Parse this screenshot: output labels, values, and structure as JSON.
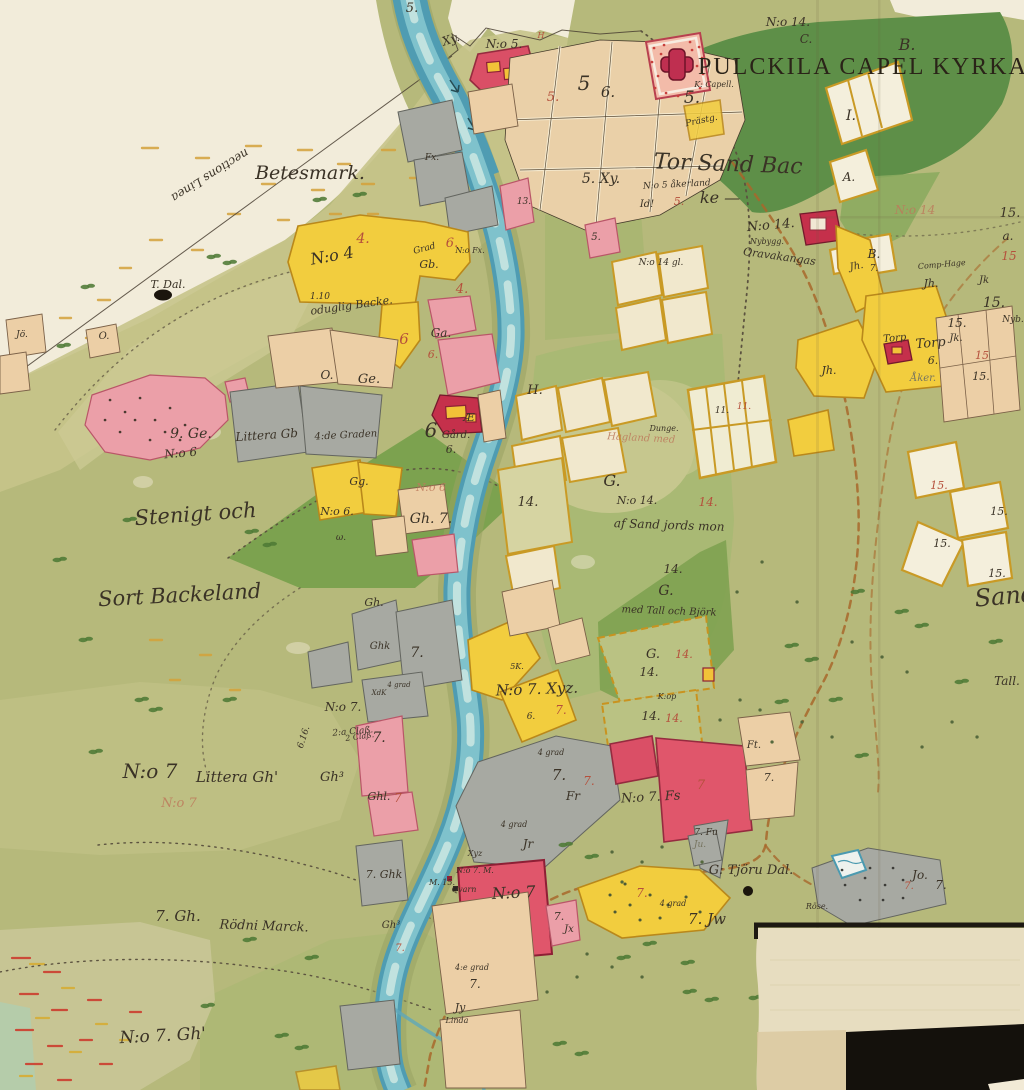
{
  "map": {
    "title": "PULCKILA CAPEL KYRKA —",
    "region_names": {
      "betesmark": "Betesmark.",
      "linea": "nections Linea",
      "stenigt": "Stenigt och",
      "backeland": "Sort Backeland",
      "torsand_1": "Tor Sand Bac",
      "torsand_2": "ke —",
      "littera_no7": "N:o 7",
      "littera_gh": "Littera Gh'",
      "rodni_1": "7. Gh.",
      "rodni_2": "Rödni Marck.",
      "no7_gh": "N:o 7. Gh'",
      "tjoru": "G: Tjöru Dal."
    }
  },
  "palette": {
    "paper": "#e9e0c6",
    "paper_light": "#f2ecda",
    "land": "#b6b97b",
    "land_light": "#c6c489",
    "forest_dark": "#5e8f48",
    "forest_mid": "#8cab5f",
    "river_deep": "#4f9cb2",
    "river_mid": "#7fc2cc",
    "river_light": "#d7ece6",
    "c_yellow": "#f2cd3e",
    "c_pink": "#eb9fa8",
    "c_red": "#da4f66",
    "c_gray": "#a7a9a2",
    "c_beige": "#eccfa6",
    "c_cream": "#f1e8cd",
    "ochre": "#c99a25",
    "ink": "#3a3226",
    "ink_red": "#b5503c",
    "road": "#a8672c",
    "black_patch": "#14110c",
    "tree": "#4e7a36"
  },
  "labels": [
    {
      "t": "N:o 14.",
      "x": 788,
      "y": 26,
      "s": 12
    },
    {
      "t": "C.",
      "x": 806,
      "y": 43,
      "s": 12
    },
    {
      "t": "B.",
      "x": 907,
      "y": 50,
      "s": 16
    },
    {
      "t": "I.",
      "x": 851,
      "y": 120,
      "s": 14
    },
    {
      "t": "A.",
      "x": 849,
      "y": 181,
      "s": 12
    },
    {
      "t": "B.",
      "x": 874,
      "y": 258,
      "s": 12
    },
    {
      "t": "7.",
      "x": 874,
      "y": 271,
      "s": 9
    },
    {
      "t": "K: Capell.",
      "x": 714,
      "y": 87,
      "s": 8
    },
    {
      "t": "Prästg.",
      "x": 702,
      "y": 123,
      "s": 9,
      "r": -12
    },
    {
      "t": "N:o 5.",
      "x": 504,
      "y": 48,
      "s": 12
    },
    {
      "t": "5.",
      "x": 412,
      "y": 12,
      "s": 13
    },
    {
      "t": "Xy.",
      "x": 452,
      "y": 43,
      "s": 12,
      "r": -18
    },
    {
      "t": "H",
      "x": 541,
      "y": 38,
      "s": 8,
      "c": "r"
    },
    {
      "t": "5.",
      "x": 553,
      "y": 101,
      "s": 13,
      "c": "r"
    },
    {
      "t": "5",
      "x": 584,
      "y": 90,
      "s": 20
    },
    {
      "t": "6.",
      "x": 608,
      "y": 97,
      "s": 15
    },
    {
      "t": "5.",
      "x": 692,
      "y": 103,
      "s": 17
    },
    {
      "t": "13.",
      "x": 524,
      "y": 204,
      "s": 9
    },
    {
      "t": "5.",
      "x": 596,
      "y": 240,
      "s": 10
    },
    {
      "t": "T. Dal.",
      "x": 168,
      "y": 288,
      "s": 11
    },
    {
      "t": "N:o 4",
      "x": 333,
      "y": 261,
      "s": 16,
      "r": -10
    },
    {
      "t": "4.",
      "x": 363,
      "y": 243,
      "s": 14,
      "c": "r"
    },
    {
      "t": "1.10",
      "x": 320,
      "y": 299,
      "s": 9
    },
    {
      "t": "oduglig Backe.",
      "x": 352,
      "y": 309,
      "s": 11,
      "r": -8
    },
    {
      "t": "Grad",
      "x": 425,
      "y": 251,
      "s": 9,
      "r": -15
    },
    {
      "t": "Gb.",
      "x": 429,
      "y": 268,
      "s": 11
    },
    {
      "t": "4.",
      "x": 462,
      "y": 293,
      "s": 13,
      "c": "r"
    },
    {
      "t": "6",
      "x": 404,
      "y": 344,
      "s": 15,
      "c": "r"
    },
    {
      "t": "Ga.",
      "x": 441,
      "y": 337,
      "s": 12
    },
    {
      "t": "6.",
      "x": 433,
      "y": 358,
      "s": 11,
      "c": "r"
    },
    {
      "t": "6.",
      "x": 452,
      "y": 247,
      "s": 13,
      "c": "r"
    },
    {
      "t": "N:o Fx.",
      "x": 470,
      "y": 253,
      "s": 8
    },
    {
      "t": "Fx.",
      "x": 432,
      "y": 160,
      "s": 9
    },
    {
      "t": "Jö.",
      "x": 22,
      "y": 337,
      "s": 9
    },
    {
      "t": "O.",
      "x": 104,
      "y": 339,
      "s": 10
    },
    {
      "t": "O.",
      "x": 327,
      "y": 379,
      "s": 12
    },
    {
      "t": "Ge.",
      "x": 369,
      "y": 383,
      "s": 13
    },
    {
      "t": "9. Ge.",
      "x": 191,
      "y": 438,
      "s": 14
    },
    {
      "t": "N:o 6",
      "x": 181,
      "y": 457,
      "s": 12,
      "r": -5
    },
    {
      "t": "Littera Gb",
      "x": 267,
      "y": 439,
      "s": 12,
      "r": -4
    },
    {
      "t": "4:de Graden",
      "x": 346,
      "y": 438,
      "s": 10,
      "r": -3
    },
    {
      "t": "N:o 6.",
      "x": 337,
      "y": 515,
      "s": 11
    },
    {
      "t": "ω.",
      "x": 341,
      "y": 540,
      "s": 9
    },
    {
      "t": "Gh.",
      "x": 374,
      "y": 606,
      "s": 11
    },
    {
      "t": "N:o 6",
      "x": 431,
      "y": 491,
      "s": 11,
      "c": "f"
    },
    {
      "t": "Gh. 7.",
      "x": 431,
      "y": 523,
      "s": 14
    },
    {
      "t": "Æ",
      "x": 469,
      "y": 421,
      "s": 11
    },
    {
      "t": "Gård.",
      "x": 456,
      "y": 438,
      "s": 10
    },
    {
      "t": "6",
      "x": 431,
      "y": 437,
      "s": 20
    },
    {
      "t": "6.",
      "x": 451,
      "y": 453,
      "s": 11
    },
    {
      "t": "Gg.",
      "x": 359,
      "y": 485,
      "s": 11
    },
    {
      "t": "H.",
      "x": 535,
      "y": 394,
      "s": 13
    },
    {
      "t": "14.",
      "x": 528,
      "y": 506,
      "s": 13
    },
    {
      "t": "5. Xy.",
      "x": 601,
      "y": 183,
      "s": 14
    },
    {
      "t": "N:o 5 åkerland",
      "x": 677,
      "y": 187,
      "s": 9,
      "r": -3
    },
    {
      "t": "Id!",
      "x": 647,
      "y": 207,
      "s": 10
    },
    {
      "t": "5.",
      "x": 679,
      "y": 205,
      "s": 11,
      "c": "r"
    },
    {
      "t": "N:o 14 gl.",
      "x": 661,
      "y": 265,
      "s": 9
    },
    {
      "t": "N:o 14.",
      "x": 771,
      "y": 229,
      "s": 13,
      "r": -5
    },
    {
      "t": "Nybygg.",
      "x": 767,
      "y": 244,
      "s": 8
    },
    {
      "t": "Oravakangas",
      "x": 779,
      "y": 260,
      "s": 11,
      "r": 8
    },
    {
      "t": "N:o 14",
      "x": 915,
      "y": 214,
      "s": 12,
      "c": "f"
    },
    {
      "t": "15.",
      "x": 1010,
      "y": 217,
      "s": 13
    },
    {
      "t": "a.",
      "x": 1008,
      "y": 240,
      "s": 12
    },
    {
      "t": "15",
      "x": 1009,
      "y": 260,
      "s": 12,
      "c": "r"
    },
    {
      "t": "Comp-Hage",
      "x": 942,
      "y": 267,
      "s": 8,
      "r": -5
    },
    {
      "t": "Jh.",
      "x": 931,
      "y": 287,
      "s": 11
    },
    {
      "t": "Jk",
      "x": 984,
      "y": 283,
      "s": 10
    },
    {
      "t": "15.",
      "x": 994,
      "y": 307,
      "s": 14
    },
    {
      "t": "Jh.",
      "x": 857,
      "y": 269,
      "s": 10,
      "r": -10
    },
    {
      "t": "Jh.",
      "x": 829,
      "y": 374,
      "s": 11
    },
    {
      "t": "Torp",
      "x": 895,
      "y": 341,
      "s": 10,
      "r": -5
    },
    {
      "t": "Torp",
      "x": 931,
      "y": 347,
      "s": 13,
      "r": -5
    },
    {
      "t": "6.",
      "x": 933,
      "y": 364,
      "s": 11
    },
    {
      "t": "15.",
      "x": 957,
      "y": 327,
      "s": 12
    },
    {
      "t": "Jk.",
      "x": 956,
      "y": 341,
      "s": 10
    },
    {
      "t": "15",
      "x": 982,
      "y": 359,
      "s": 11,
      "c": "r"
    },
    {
      "t": "15.",
      "x": 981,
      "y": 380,
      "s": 11
    },
    {
      "t": "Nyb.",
      "x": 1013,
      "y": 322,
      "s": 9
    },
    {
      "t": "Åker.",
      "x": 923,
      "y": 381,
      "s": 10,
      "c": "g"
    },
    {
      "t": "G.",
      "x": 612,
      "y": 486,
      "s": 16
    },
    {
      "t": "N:o 14.",
      "x": 637,
      "y": 504,
      "s": 11
    },
    {
      "t": "14.",
      "x": 708,
      "y": 506,
      "s": 12,
      "c": "r"
    },
    {
      "t": "af Sand jords mon",
      "x": 669,
      "y": 529,
      "s": 12,
      "r": 2
    },
    {
      "t": "Hagland med",
      "x": 641,
      "y": 441,
      "s": 10,
      "c": "f",
      "r": 3
    },
    {
      "t": "Dunge.",
      "x": 664,
      "y": 431,
      "s": 8
    },
    {
      "t": "14.",
      "x": 673,
      "y": 573,
      "s": 12
    },
    {
      "t": "G.",
      "x": 666,
      "y": 595,
      "s": 14
    },
    {
      "t": "med Tall och Björk",
      "x": 669,
      "y": 614,
      "s": 10,
      "r": 2
    },
    {
      "t": "G.",
      "x": 653,
      "y": 658,
      "s": 13
    },
    {
      "t": "14.",
      "x": 684,
      "y": 658,
      "s": 11,
      "c": "r"
    },
    {
      "t": "14.",
      "x": 649,
      "y": 676,
      "s": 12
    },
    {
      "t": "K:op",
      "x": 667,
      "y": 699,
      "s": 8
    },
    {
      "t": "14.",
      "x": 651,
      "y": 720,
      "s": 12
    },
    {
      "t": "14.",
      "x": 674,
      "y": 722,
      "s": 11,
      "c": "r"
    },
    {
      "t": "11.",
      "x": 722,
      "y": 413,
      "s": 9
    },
    {
      "t": "11.",
      "x": 744,
      "y": 409,
      "s": 9,
      "c": "r"
    },
    {
      "t": "N:o 7. Xyz.",
      "x": 537,
      "y": 694,
      "s": 15,
      "r": -2
    },
    {
      "t": "7.",
      "x": 561,
      "y": 714,
      "s": 12,
      "c": "r"
    },
    {
      "t": "4 grad",
      "x": 551,
      "y": 755,
      "s": 8
    },
    {
      "t": "7.",
      "x": 559,
      "y": 780,
      "s": 15
    },
    {
      "t": "7.",
      "x": 589,
      "y": 785,
      "s": 12,
      "c": "r"
    },
    {
      "t": "Fr",
      "x": 573,
      "y": 800,
      "s": 12
    },
    {
      "t": "4 grad",
      "x": 514,
      "y": 827,
      "s": 8
    },
    {
      "t": "Jr",
      "x": 528,
      "y": 848,
      "s": 12
    },
    {
      "t": "N:o 7. Fs",
      "x": 651,
      "y": 801,
      "s": 13,
      "r": -3
    },
    {
      "t": "7",
      "x": 701,
      "y": 789,
      "s": 13,
      "c": "r"
    },
    {
      "t": "7. Fu",
      "x": 706,
      "y": 835,
      "s": 9
    },
    {
      "t": "Ft.",
      "x": 754,
      "y": 748,
      "s": 10
    },
    {
      "t": "7.",
      "x": 769,
      "y": 781,
      "s": 11
    },
    {
      "t": "Ju.",
      "x": 700,
      "y": 847,
      "s": 9,
      "c": "g"
    },
    {
      "t": "7. Jw",
      "x": 707,
      "y": 924,
      "s": 15
    },
    {
      "t": "7.",
      "x": 642,
      "y": 897,
      "s": 12,
      "c": "r"
    },
    {
      "t": "4 grad",
      "x": 673,
      "y": 906,
      "s": 8
    },
    {
      "t": "7.",
      "x": 559,
      "y": 920,
      "s": 11
    },
    {
      "t": "Jx",
      "x": 569,
      "y": 932,
      "s": 10
    },
    {
      "t": "Xyz",
      "x": 475,
      "y": 856,
      "s": 8
    },
    {
      "t": "N:o 7. M.",
      "x": 475,
      "y": 873,
      "s": 8
    },
    {
      "t": "M. 15.",
      "x": 442,
      "y": 885,
      "s": 8
    },
    {
      "t": "Qvarn",
      "x": 464,
      "y": 892,
      "s": 8
    },
    {
      "t": "N:o 7",
      "x": 514,
      "y": 898,
      "s": 16,
      "r": -3
    },
    {
      "t": "4:e grad",
      "x": 472,
      "y": 970,
      "s": 8
    },
    {
      "t": "7.",
      "x": 475,
      "y": 988,
      "s": 12
    },
    {
      "t": "Jy",
      "x": 460,
      "y": 1011,
      "s": 11
    },
    {
      "t": "Linda",
      "x": 457,
      "y": 1023,
      "s": 8
    },
    {
      "t": "Röse.",
      "x": 817,
      "y": 909,
      "s": 8
    },
    {
      "t": "Jo.",
      "x": 920,
      "y": 879,
      "s": 12
    },
    {
      "t": "7.",
      "x": 941,
      "y": 889,
      "s": 12
    },
    {
      "t": "7.",
      "x": 909,
      "y": 889,
      "s": 10,
      "c": "r"
    },
    {
      "t": "Gh³",
      "x": 332,
      "y": 781,
      "s": 13
    },
    {
      "t": "Ghl.",
      "x": 379,
      "y": 800,
      "s": 11
    },
    {
      "t": "7",
      "x": 398,
      "y": 802,
      "s": 12,
      "c": "r"
    },
    {
      "t": "2 Claß.",
      "x": 360,
      "y": 739,
      "s": 8,
      "r": -8
    },
    {
      "t": "N:o 7",
      "x": 179,
      "y": 807,
      "s": 13,
      "c": "f"
    },
    {
      "t": "7. Ghk",
      "x": 384,
      "y": 878,
      "s": 11
    },
    {
      "t": "Gh³",
      "x": 391,
      "y": 928,
      "s": 10
    },
    {
      "t": "7.",
      "x": 400,
      "y": 951,
      "s": 10,
      "c": "r"
    },
    {
      "t": "N:o 7.",
      "x": 343,
      "y": 711,
      "s": 12
    },
    {
      "t": "2:a Claß.",
      "x": 353,
      "y": 734,
      "s": 9,
      "r": -5
    },
    {
      "t": "6.16.",
      "x": 306,
      "y": 738,
      "s": 9,
      "r": -72
    },
    {
      "t": "7.",
      "x": 379,
      "y": 742,
      "s": 14
    },
    {
      "t": "Ghk",
      "x": 380,
      "y": 649,
      "s": 10
    },
    {
      "t": "7.",
      "x": 417,
      "y": 657,
      "s": 14
    },
    {
      "t": "4 grad",
      "x": 399,
      "y": 687,
      "s": 7
    },
    {
      "t": "XdK",
      "x": 379,
      "y": 695,
      "s": 7
    },
    {
      "t": "5K.",
      "x": 517,
      "y": 669,
      "s": 8
    },
    {
      "t": "6.",
      "x": 531,
      "y": 719,
      "s": 9
    },
    {
      "t": "Sand",
      "x": 1006,
      "y": 604,
      "s": 24,
      "r": -5
    },
    {
      "t": "Tall.",
      "x": 1007,
      "y": 685,
      "s": 12
    },
    {
      "t": "15.",
      "x": 939,
      "y": 489,
      "s": 11,
      "c": "r"
    },
    {
      "t": "15.",
      "x": 999,
      "y": 515,
      "s": 11
    },
    {
      "t": "15.",
      "x": 942,
      "y": 547,
      "s": 11
    },
    {
      "t": "15.",
      "x": 997,
      "y": 577,
      "s": 11
    }
  ]
}
